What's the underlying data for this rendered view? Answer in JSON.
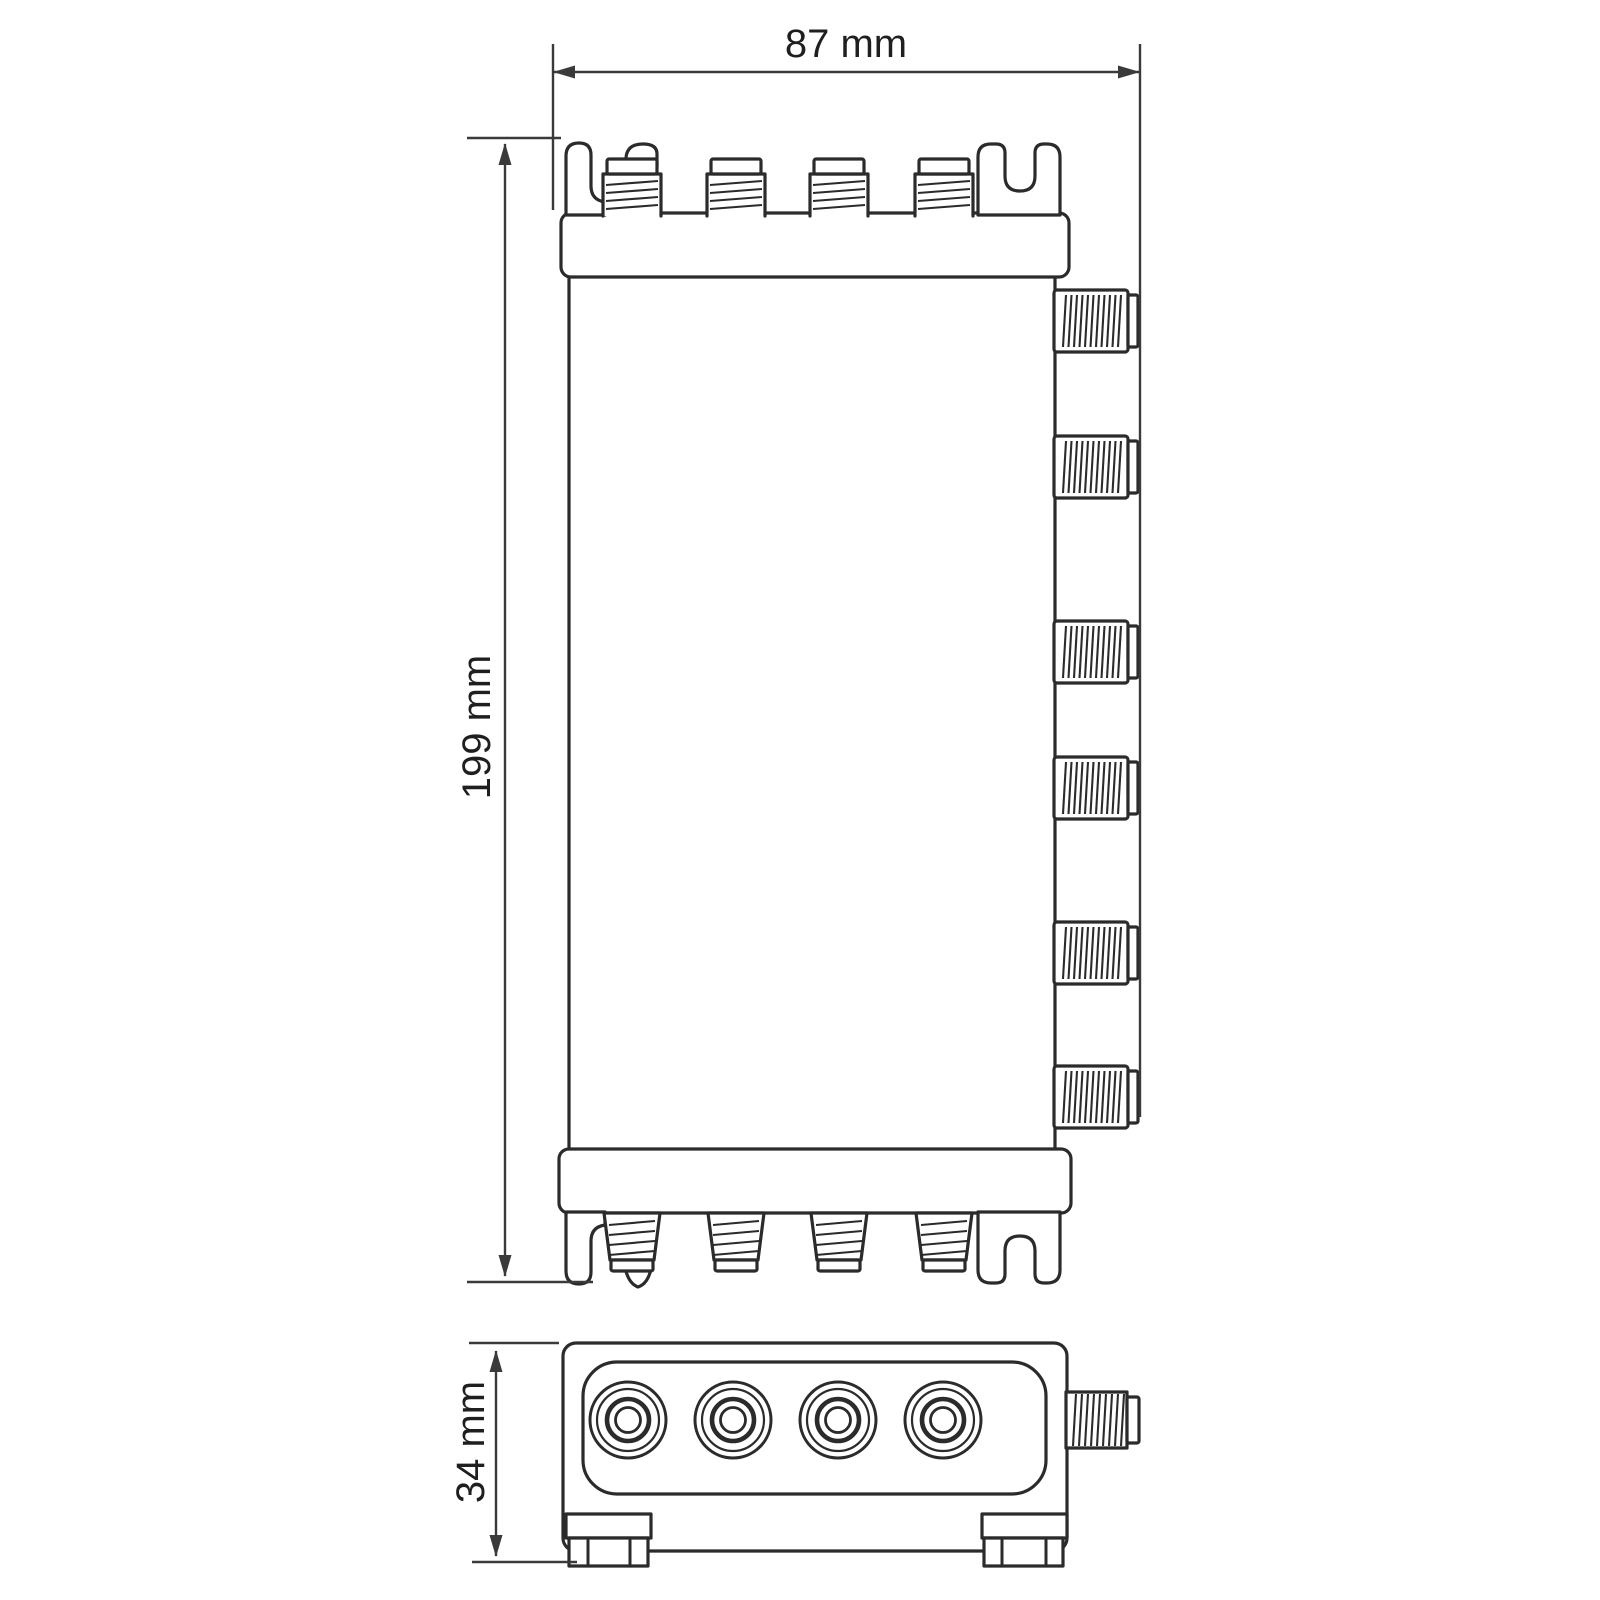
{
  "drawing": {
    "kind": "technical-dimension-drawing",
    "background": "#ffffff",
    "line_color": "#2b2b2b",
    "dimension_color": "#3a3a3a",
    "dimensions": {
      "width_label": "87 mm",
      "height_label": "199 mm",
      "depth_label": "34 mm"
    },
    "top_view": {
      "top_connector_count": 4,
      "right_connector_count": 6,
      "bottom_connector_count": 4,
      "mounting_tab_count": 4
    },
    "front_view": {
      "port_count": 4,
      "side_connector_count": 1,
      "foot_count": 2
    }
  }
}
